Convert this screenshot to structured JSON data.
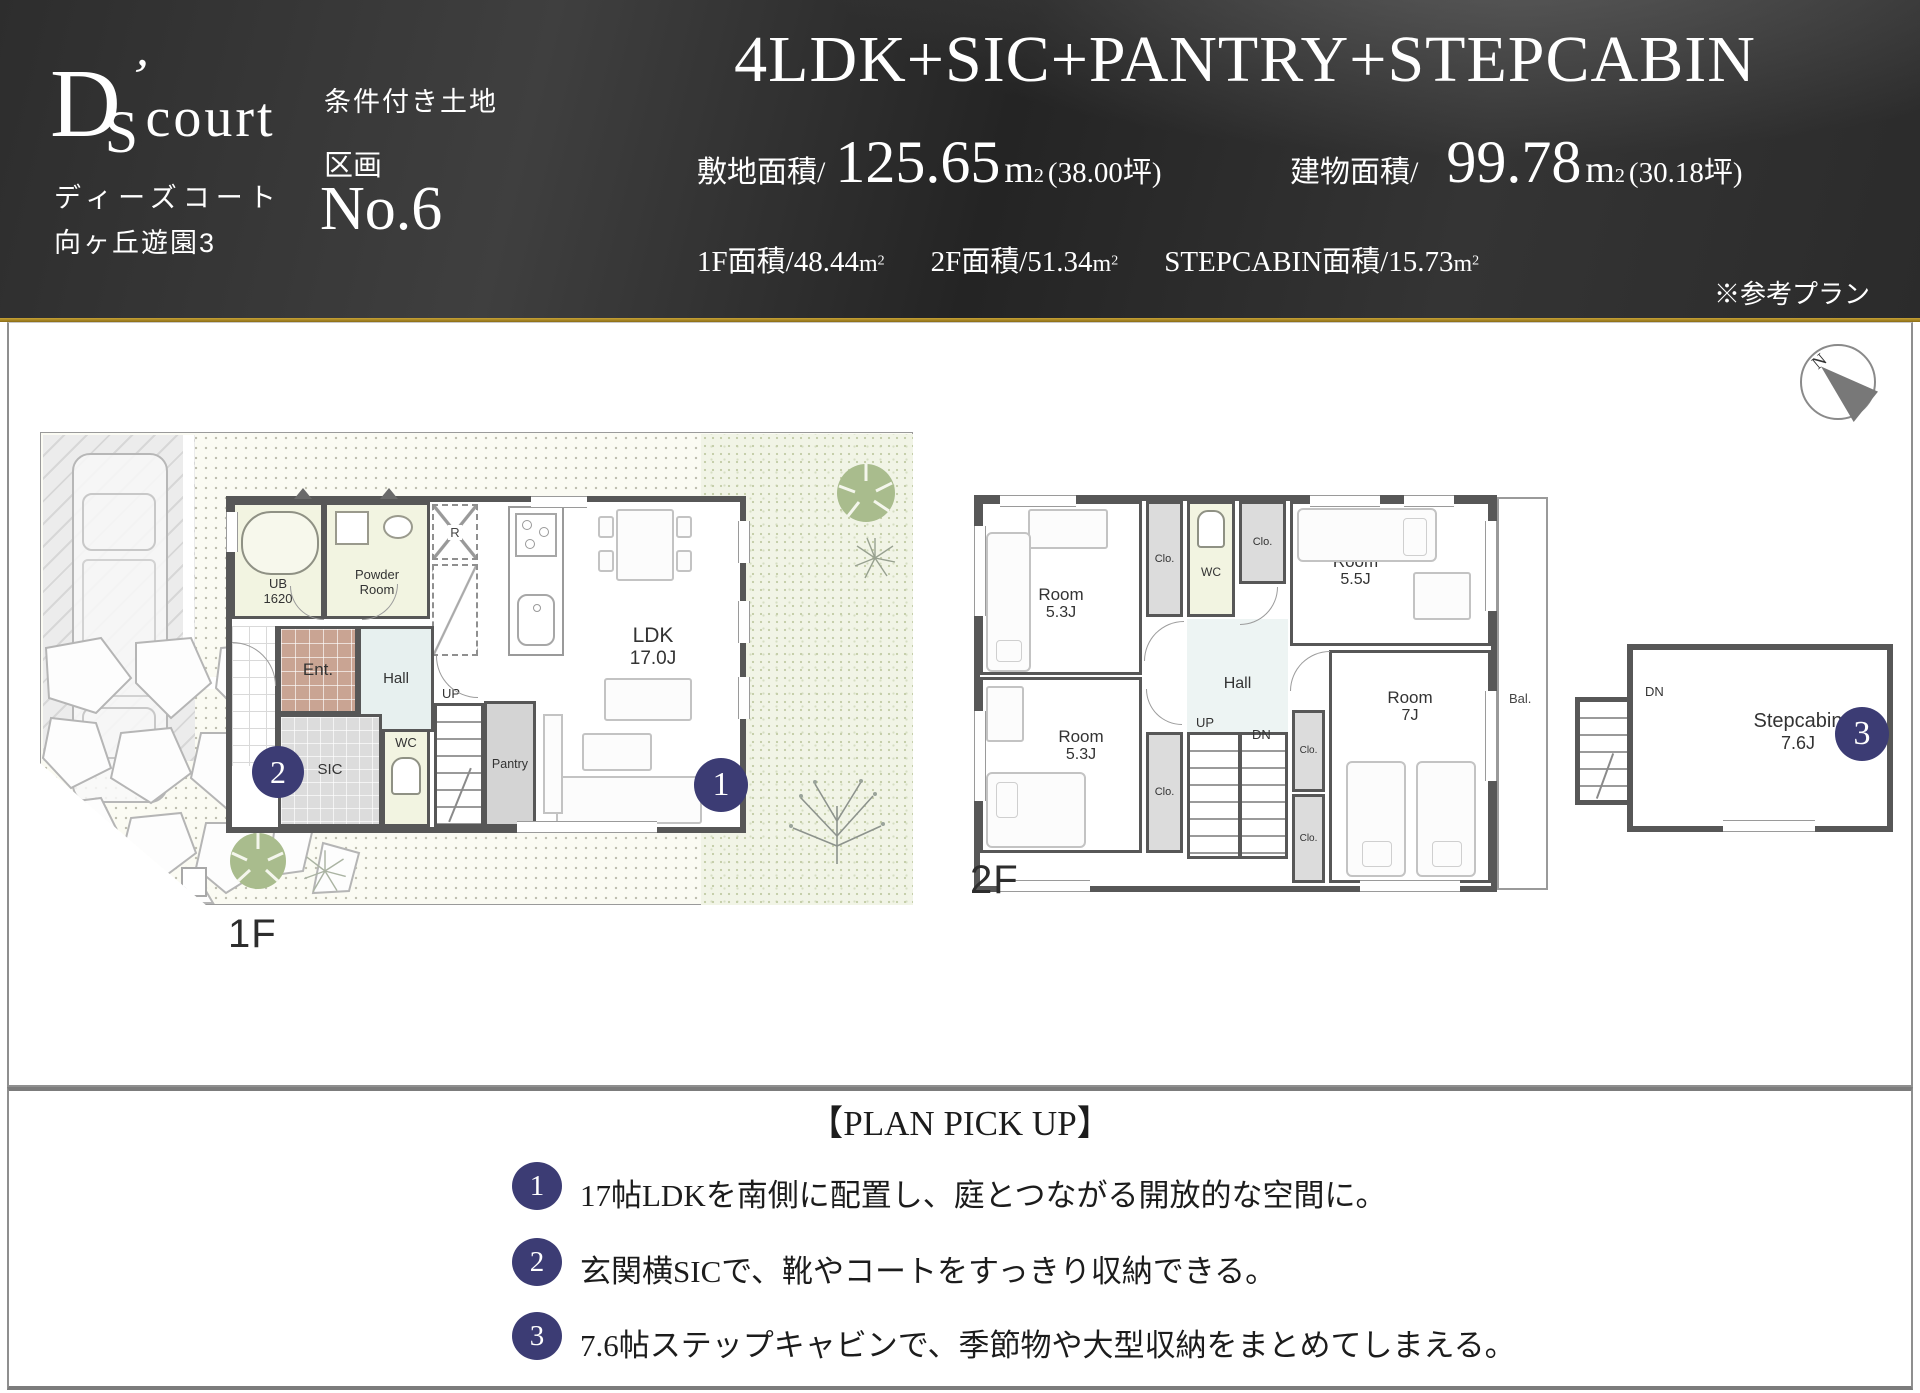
{
  "header": {
    "logo": {
      "d": "D",
      "s": "S",
      "apos": "’",
      "rest": "court",
      "sub1": "ディーズコート",
      "sub2": "向ヶ丘遊園3"
    },
    "condition": "条件付き土地",
    "lot_label": "区画",
    "lot_no": "No.6",
    "title": "4LDK+SIC+PANTRY+STEPCABIN",
    "unit_m": "m",
    "unit_sup": "2",
    "site_area": {
      "label": "敷地面積/",
      "value": "125.65",
      "tsubo": "(38.00坪)"
    },
    "building_area": {
      "label": "建物面積/",
      "value": "99.78",
      "tsubo": "(30.18坪)"
    },
    "sub_areas": [
      {
        "label": "1F面積/",
        "value": "48.44"
      },
      {
        "label": "2F面積/",
        "value": "51.34"
      },
      {
        "label": "STEPCABIN面積/",
        "value": "15.73"
      }
    ],
    "note": "※参考プラン"
  },
  "plans": {
    "compass_n": "N",
    "floor1": {
      "label": "1F",
      "ldk": "LDK",
      "ldk_size": "17.0J",
      "ub": "UB",
      "ub_size": "1620",
      "powder1": "Powder",
      "powder2": "Room",
      "fridge": "R",
      "ent": "Ent.",
      "hall": "Hall",
      "wc": "WC",
      "sic": "SIC",
      "pantry": "Pantry",
      "up": "UP"
    },
    "floor2": {
      "label": "2F",
      "room": "Room",
      "size_tl": "5.3J",
      "size_tr": "5.5J",
      "size_bl": "5.3J",
      "size_br": "7J",
      "clo": "Clo.",
      "wc": "WC",
      "hall": "Hall",
      "up": "UP",
      "dn": "DN",
      "bal": "Bal."
    },
    "stepcabin": {
      "dn": "DN",
      "name": "Stepcabin",
      "size": "7.6J"
    },
    "badges": {
      "b1": "1",
      "b2": "2",
      "b3": "3"
    }
  },
  "pickup": {
    "title": "【PLAN PICK UP】",
    "items": [
      {
        "num": "1",
        "text": "17帖LDKを南側に配置し、庭とつながる開放的な空間に。"
      },
      {
        "num": "2",
        "text": "玄関横SICで、靴やコートをすっきり収納できる。"
      },
      {
        "num": "3",
        "text": "7.6帖ステップキャビンで、季節物や大型収納をまとめてしまえる。"
      }
    ]
  },
  "colors": {
    "badge": "#3c3c74",
    "gold": "#aa8a1e",
    "wall": "#575757"
  }
}
